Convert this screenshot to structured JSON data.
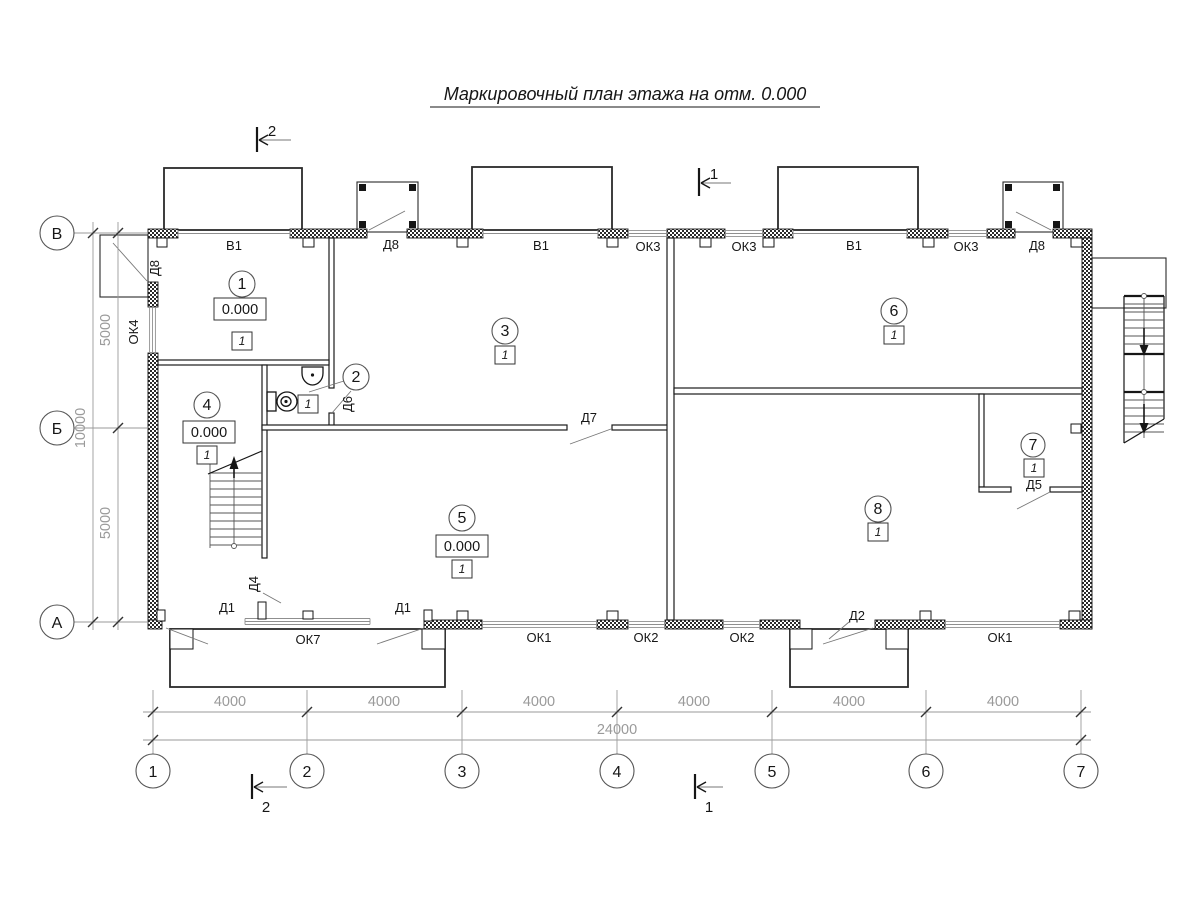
{
  "title": "Маркировочный план этажа на отм. 0.000",
  "palette": {
    "paper": "#ffffff",
    "ink": "#161616",
    "dim_text": "#9a9a9a"
  },
  "axes": {
    "left": [
      "В",
      "Б",
      "А"
    ],
    "bottom": [
      "1",
      "2",
      "3",
      "4",
      "5",
      "6",
      "7"
    ]
  },
  "dims": {
    "left": [
      "5000",
      "5000"
    ],
    "left_total": "10000",
    "bottom": [
      "4000",
      "4000",
      "4000",
      "4000",
      "4000",
      "4000"
    ],
    "bottom_total": "24000"
  },
  "sections": {
    "one": "1",
    "two": "2"
  },
  "rooms": [
    {
      "num": "1",
      "elev": "0.000",
      "mark": "1"
    },
    {
      "num": "2",
      "mark": "1"
    },
    {
      "num": "3",
      "mark": "1"
    },
    {
      "num": "4",
      "elev": "0.000",
      "mark": "1"
    },
    {
      "num": "5",
      "elev": "0.000",
      "mark": "1"
    },
    {
      "num": "6",
      "mark": "1"
    },
    {
      "num": "7",
      "mark": "1"
    },
    {
      "num": "8",
      "mark": "1"
    }
  ],
  "openings": {
    "top": [
      "В1",
      "Д8",
      "В1",
      "ОК3",
      "ОК3",
      "В1",
      "ОК3",
      "Д8"
    ],
    "left": [
      "Д8",
      "ОК4"
    ],
    "bottom": [
      "Д1",
      "ОК7",
      "Д1",
      "ОК1",
      "ОК2",
      "ОК2",
      "Д2",
      "ОК1"
    ],
    "inner": [
      "Д6",
      "Д7",
      "Д4",
      "Д5"
    ]
  }
}
